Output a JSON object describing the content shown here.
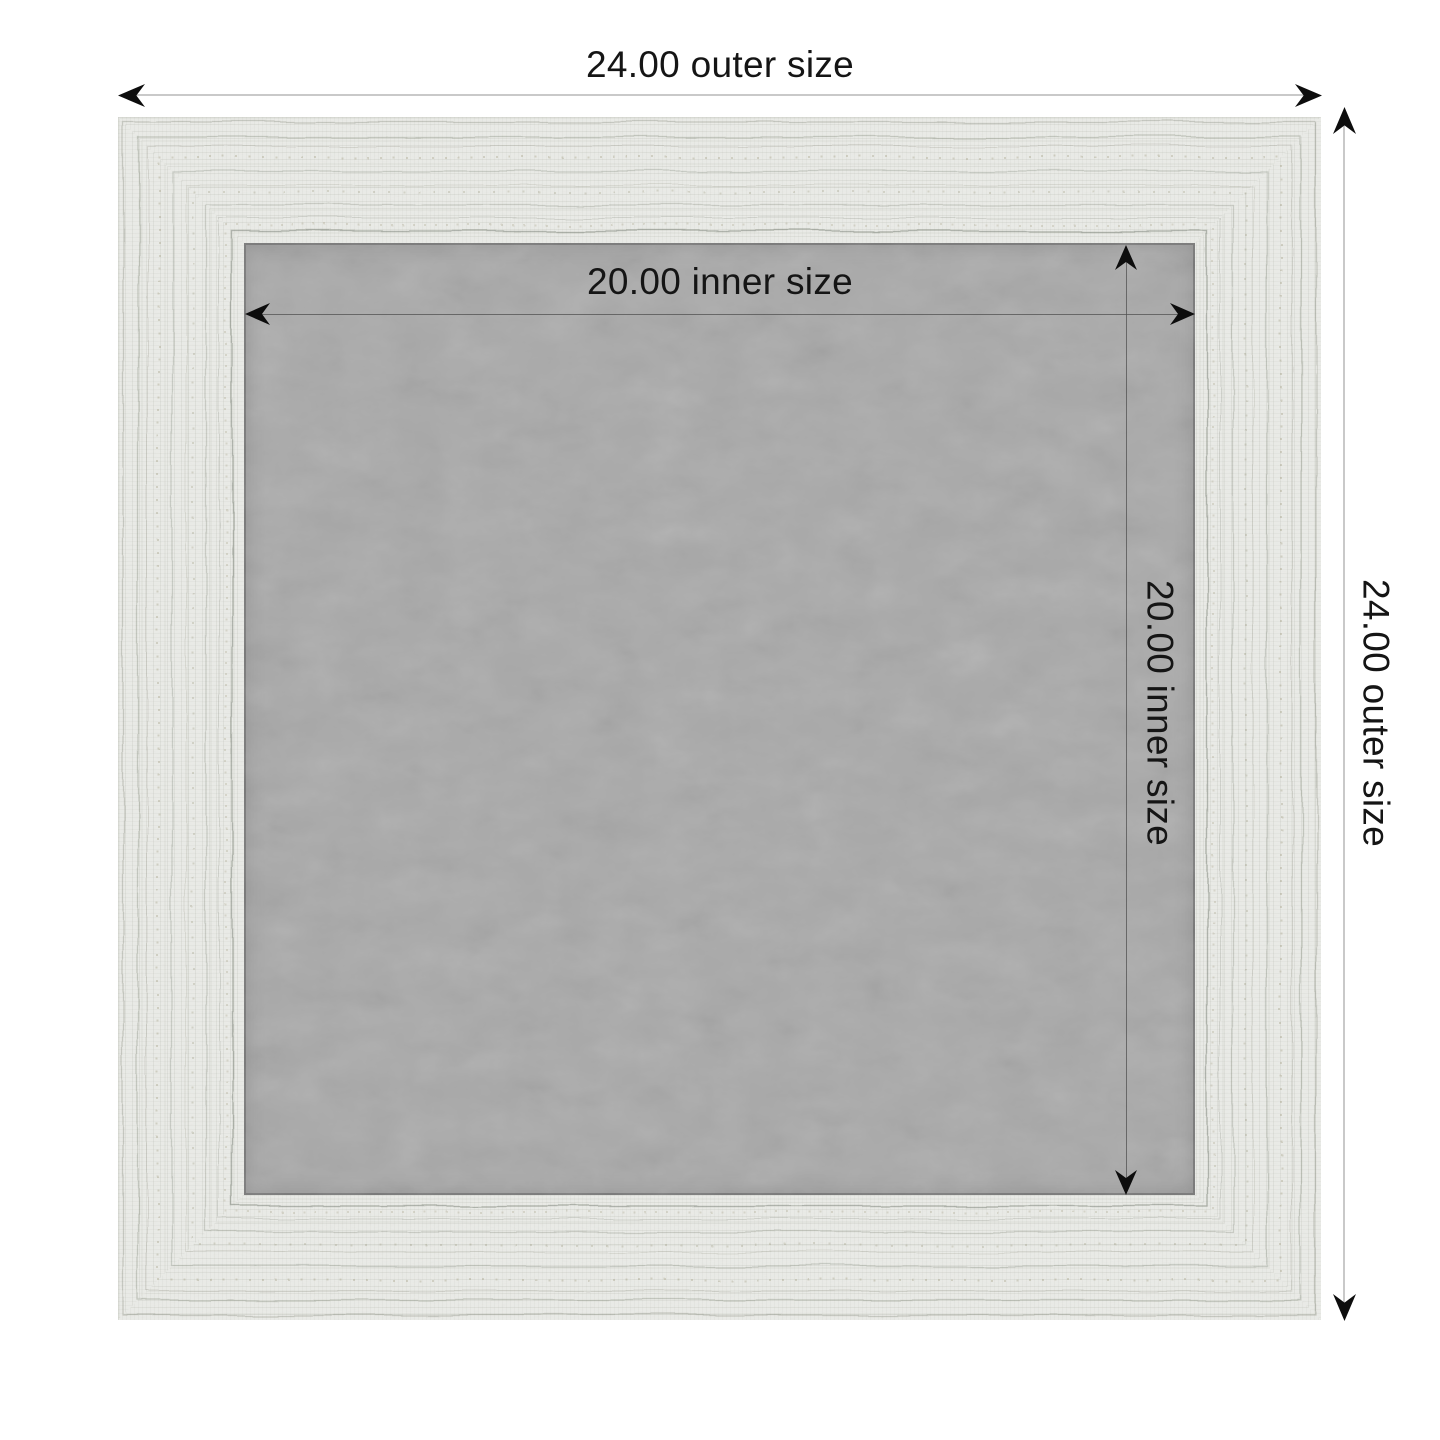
{
  "diagram": {
    "kind": "product-frame-dimension-diagram",
    "labels": {
      "outer_width": "24.00 outer size",
      "outer_height": "24.00 outer size",
      "inner_width": "20.00 inner size",
      "inner_height": "20.00 inner size"
    },
    "values": {
      "outer_size": "24.00",
      "inner_size": "20.00"
    },
    "colors": {
      "page_background": "#ffffff",
      "frame_wood": "#eaebe7",
      "frame_grain": "#7a8270",
      "inner_board": "#a9a9a9",
      "outer_dimension_line": "#c9c9c9",
      "inner_dimension_line": "#505050",
      "arrowhead": "#0d0d0d",
      "label_text": "#151515"
    },
    "icons": {
      "arrow_left": "arrow-left-icon",
      "arrow_right": "arrow-right-icon",
      "arrow_up": "arrow-up-icon",
      "arrow_down": "arrow-down-icon"
    }
  }
}
